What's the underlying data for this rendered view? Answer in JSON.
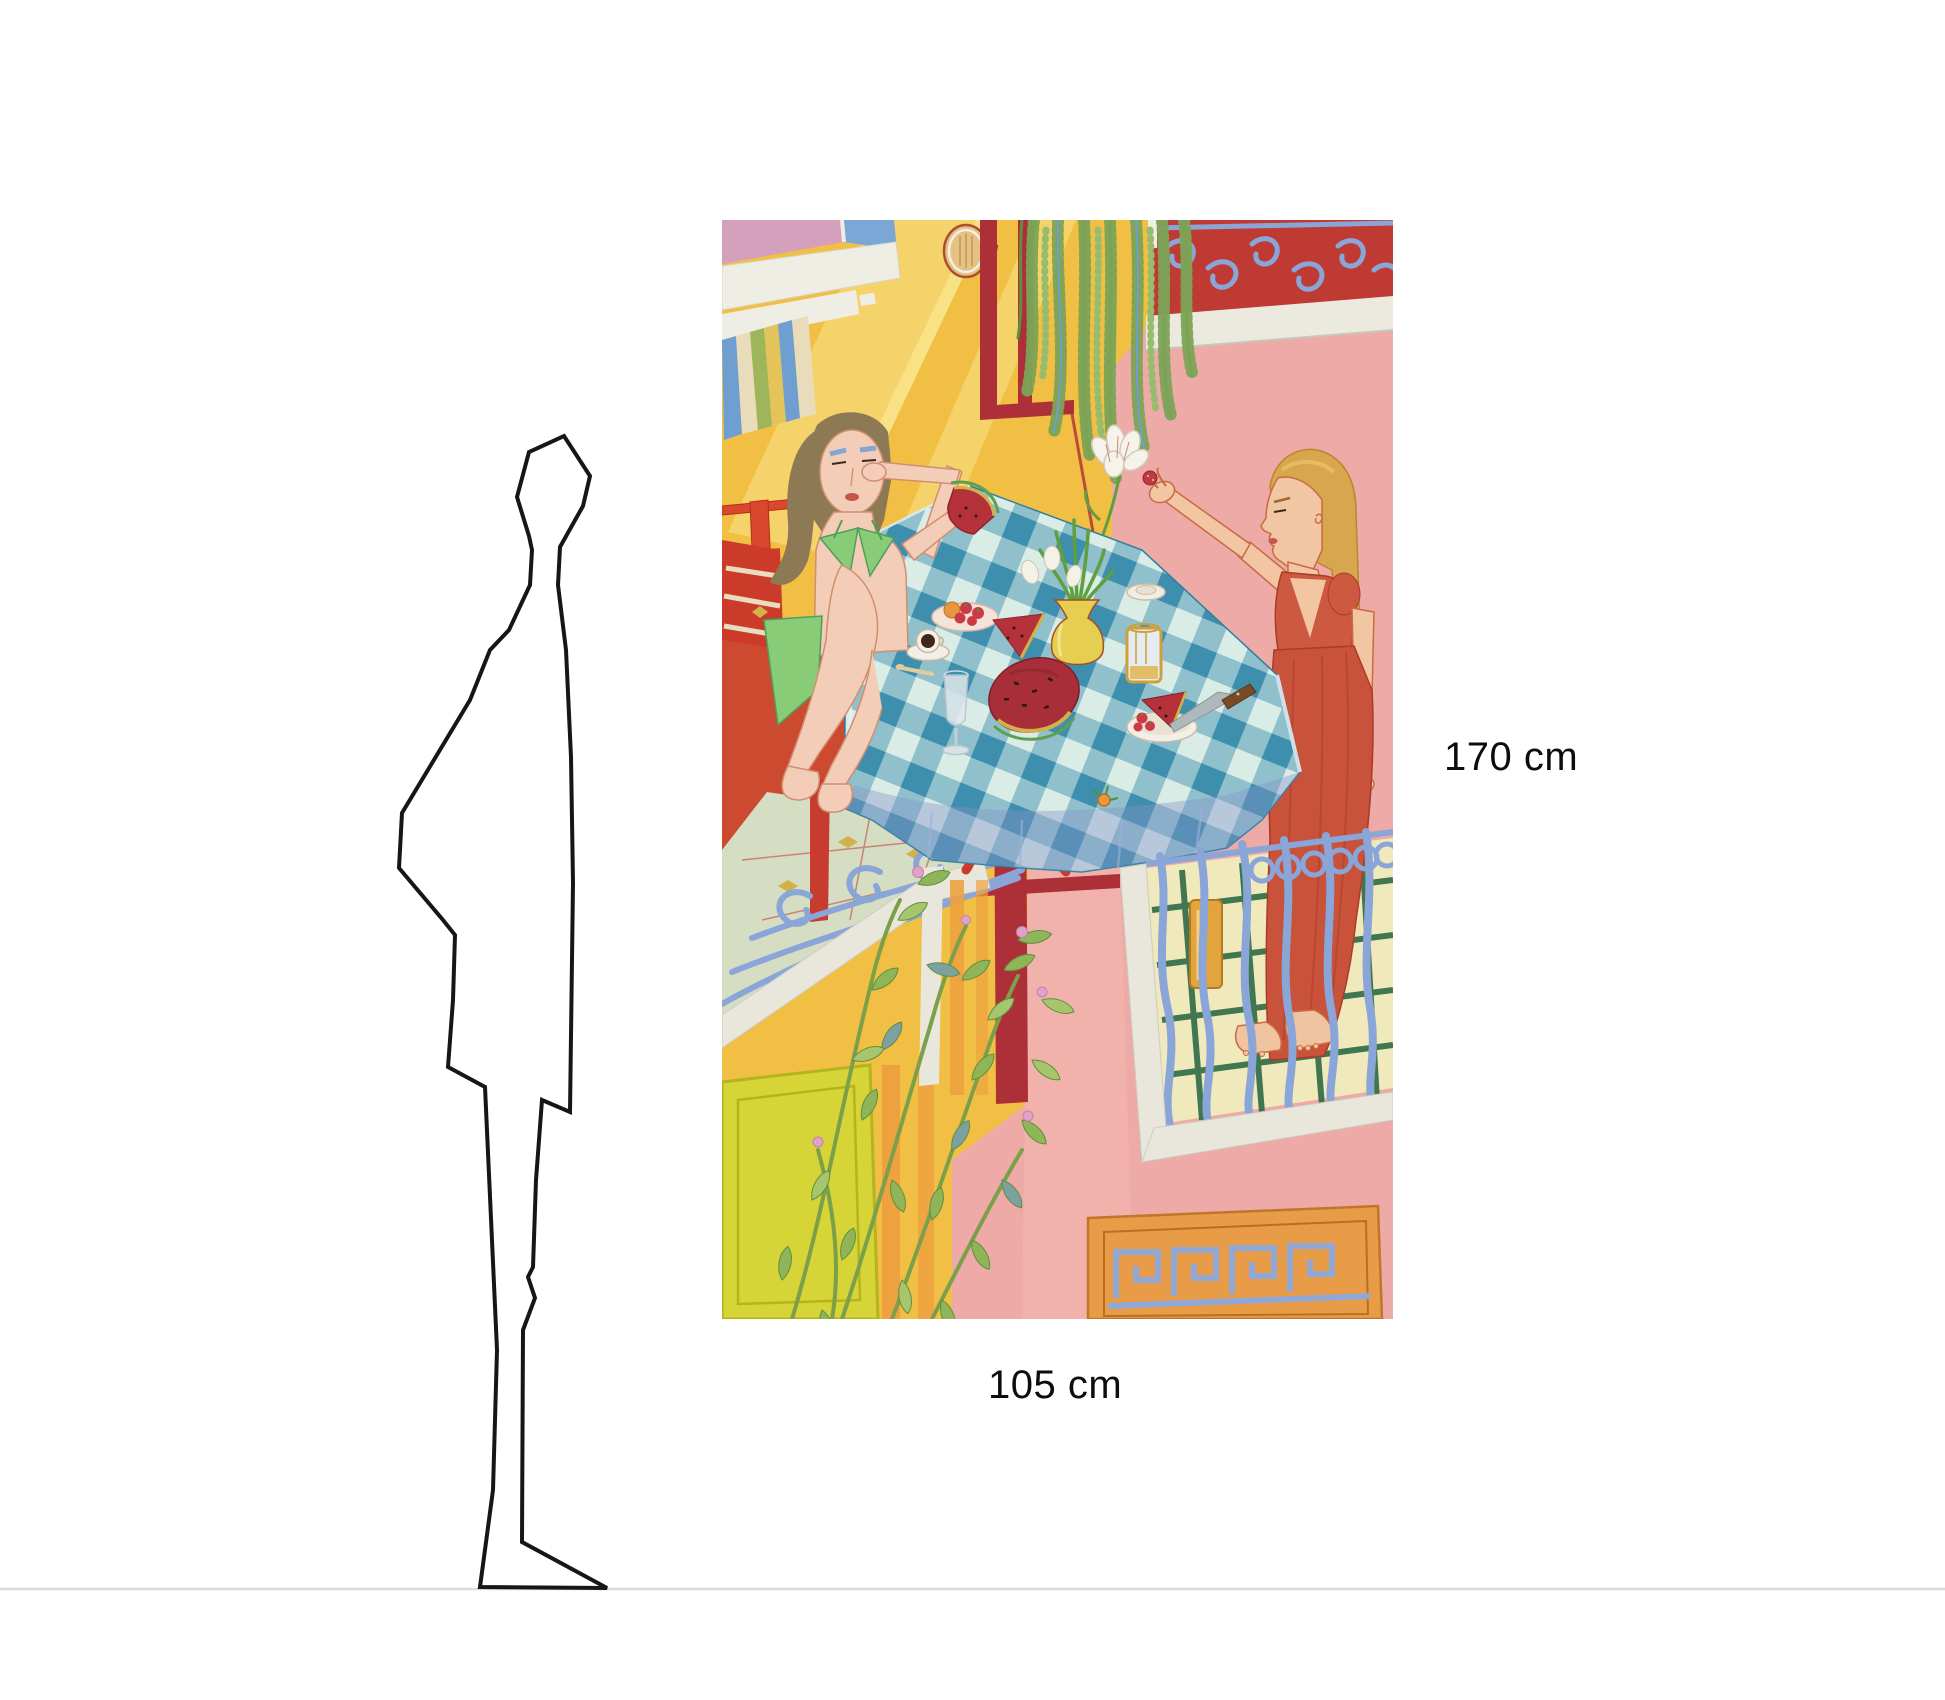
{
  "size_comparison": {
    "height_label": "170 cm",
    "width_label": "105 cm"
  },
  "colors": {
    "background": "#ffffff",
    "floor_line": "#dcdcdc",
    "silhouette_outline": "#161616",
    "label_text": "#0d0d0d"
  },
  "artwork": {
    "palette": {
      "wall_yellow": "#f1bf43",
      "light_beam": "#f6d36a",
      "wall_pink": "#edaaa6",
      "wall_red": "#bf3a32",
      "door_red": "#ad2f38",
      "railing_blue": "#8aa5d8",
      "tablecloth_teal": "#3e8eae",
      "tablecloth_mint": "#d9ece6",
      "watermelon_red": "#a82f3a",
      "dress_red": "#c9523a",
      "bikini_green": "#88cc78",
      "leaf_green": "#8fb558",
      "tile_cream": "#efe9bc",
      "tile_green": "#2f6b45",
      "panel_orange": "#e89c48"
    }
  }
}
